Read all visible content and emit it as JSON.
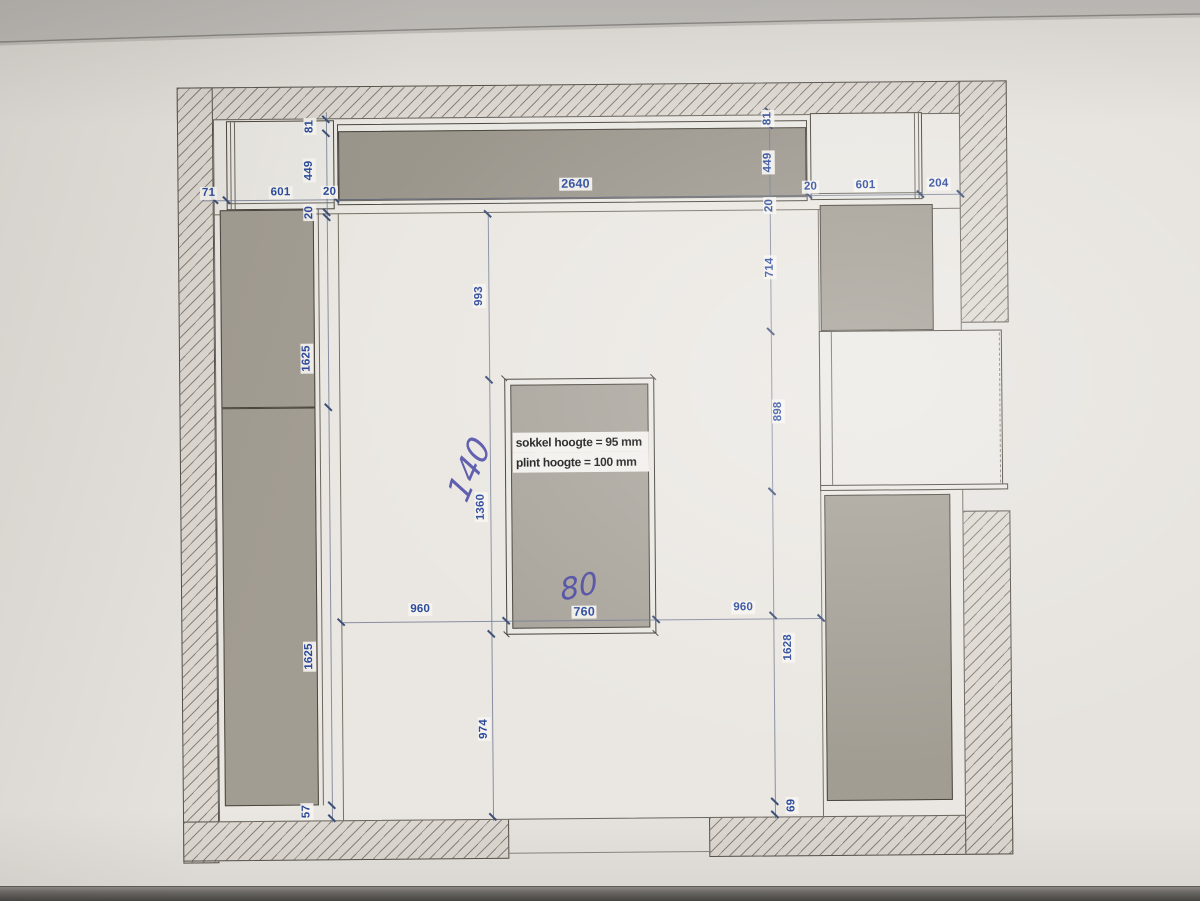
{
  "island_note": {
    "line1": "sokkel hoogte = 95 mm",
    "line2": "plint hoogte = 100 mm"
  },
  "handwritten": {
    "h140": "140",
    "h80": "80"
  },
  "dims": {
    "w71": "71",
    "w601l": "601",
    "w20l": "20",
    "w2640": "2640",
    "w20r": "20",
    "w601r": "601",
    "w204": "204",
    "l81": "81",
    "l449": "449",
    "l20": "20",
    "l1625a": "1625",
    "l1625b": "1625",
    "l57": "57",
    "r81": "81",
    "r449": "449",
    "r20": "20",
    "r714": "714",
    "r898": "898",
    "r1628": "1628",
    "r69": "69",
    "c993": "993",
    "c1360": "1360",
    "c974": "974",
    "b960l": "960",
    "b760": "760",
    "b960r": "960"
  },
  "colors": {
    "paper": "#e6e3de",
    "wall_fill": "#ddd8d1",
    "cabinet_fill": "#a29d93",
    "dim_text": "#2b4a9c",
    "ink": "#4241a2",
    "note_text": "#161616"
  }
}
